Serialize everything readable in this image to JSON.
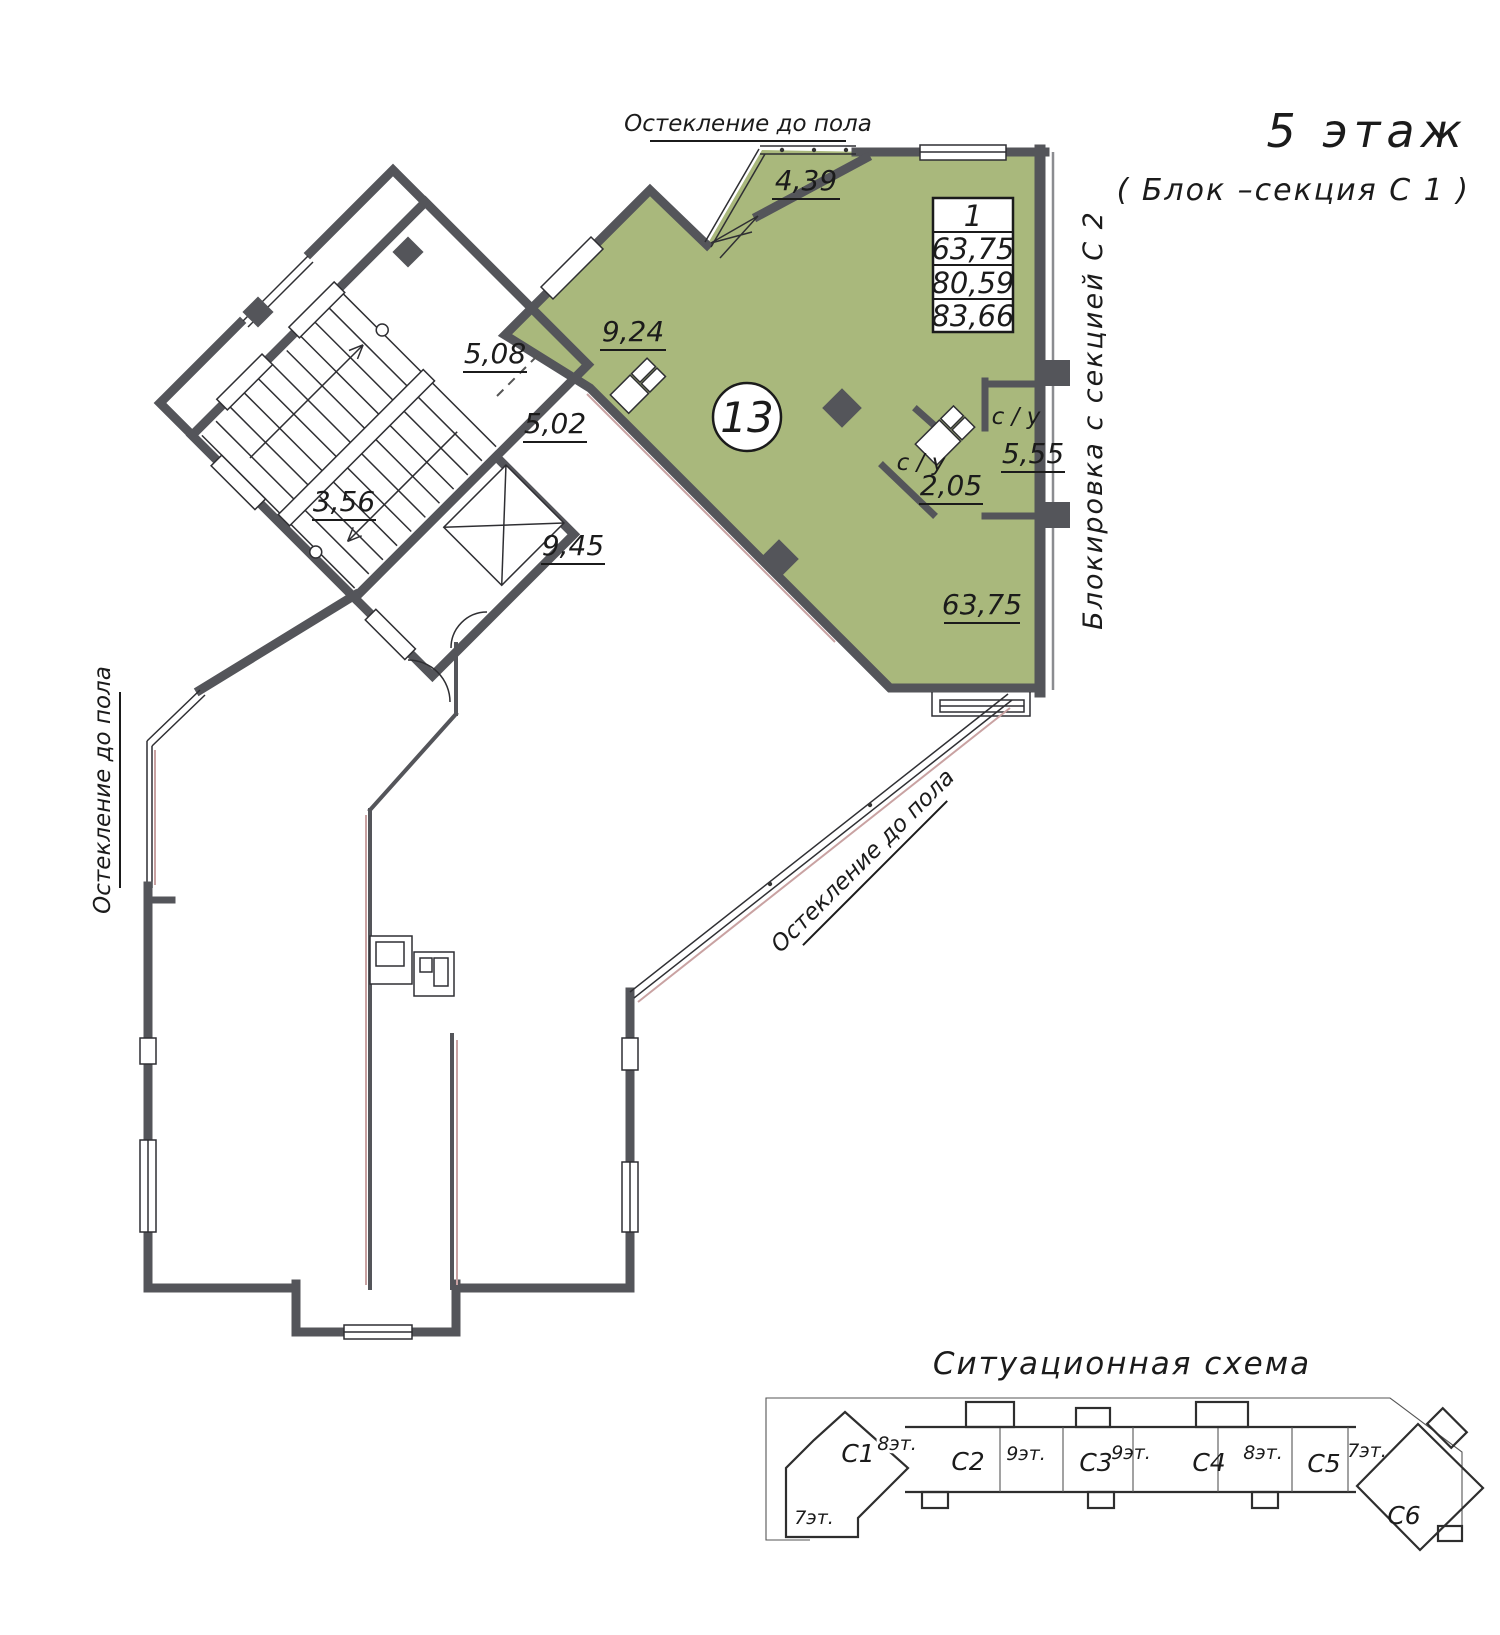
{
  "colors": {
    "highlight_green": "#a9b87c",
    "wall_dark": "#54555a",
    "glazing_pink": "#c9a2a2"
  },
  "header": {
    "floor_title": "5 этаж",
    "section_subtitle": "( Блок –секция С 1 )"
  },
  "apartment": {
    "number_badge": "13",
    "info_table": {
      "rooms_count": "1",
      "living_area": "63,75",
      "area_no_summer": "80,59",
      "total_area": "83,66"
    },
    "room_areas": {
      "balcony": "4,39",
      "bedroom": "9,24",
      "hall_upper": "5,08",
      "hall_lower": "5,02",
      "stair_landing": "3,56",
      "corridor": "9,45",
      "wc_small": "2,05",
      "wc_large": "5,55",
      "living_room": "63,75"
    },
    "wc_label_small": "с / у",
    "wc_label_large": "с / у"
  },
  "annotations": {
    "glazing_top": "Остекление до пола",
    "glazing_left": "Остекление до пола",
    "glazing_diagonal": "Остекление до пола",
    "section_blocking": "Блокировка с секцией С 2"
  },
  "situational_scheme": {
    "title": "Ситуационная схема",
    "sections": [
      {
        "label": "С1",
        "floors": "8эт."
      },
      {
        "label": "С2",
        "floors": "9эт."
      },
      {
        "label": "С3",
        "floors": "9эт."
      },
      {
        "label": "С4",
        "floors": "8эт."
      },
      {
        "label": "С5",
        "floors": "7эт."
      },
      {
        "label": "С6",
        "floors": ""
      }
    ],
    "c1_lower_floors": "7эт."
  }
}
